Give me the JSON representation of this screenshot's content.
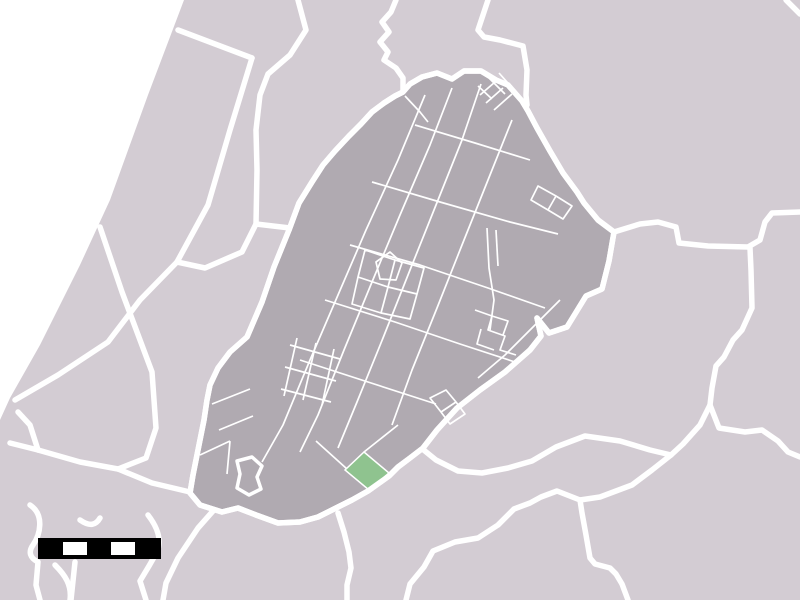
{
  "map": {
    "width": 800,
    "height": 600,
    "colors": {
      "sea": "#ffffff",
      "land": "#d3ccd3",
      "municipality": "#b0aab1",
      "selected_locality": "#8fc38f",
      "border": "#ffffff",
      "scalebar_bar": "#000000",
      "scalebar_block": "#ffffff"
    },
    "sea_path": "M 0,0 L 184,0 L 148,95 L 110,200 L 80,265 L 40,345 L 10,398 L 0,420 Z",
    "municipality_outline": "M 403,92 L 410,84 L 422,77 L 437,73 L 452,79 L 464,71 L 481,71 L 496,80 L 508,85 L 515,93 L 522,101 L 528,111 L 537,128 L 550,151 L 563,173 L 577,192 L 584,203 L 598,220 L 614,232 L 609,261 L 602,289 L 586,296 L 567,327 L 549,333 L 537,318 L 541,336 L 530,350 L 505,372 L 480,390 L 457,408 L 437,430 L 423,448 L 410,458 L 398,467 L 389,476 L 368,491 L 352,500 L 336,508 L 318,517 L 300,522 L 278,523 L 256,515 L 238,508 L 222,512 L 200,505 L 190,493 L 193,475 L 198,450 L 204,420 L 207,400 L 210,385 L 218,368 L 230,352 L 247,337 L 262,302 L 274,267 L 289,230 L 299,203 L 312,182 L 323,165 L 335,151 L 349,136 L 361,124 L 372,112 L 384,103 L 395,96 Z",
    "selected_locality_path": "M 364,452 L 389,473 L 369,490 L 345,470 Z",
    "lake_outline_path": "M 237,461 L 252,457 L 262,466 L 257,477 L 261,489 L 249,495 L 237,488 L 240,474 Z",
    "neighbor_borders": [
      "M 178,30 L 252,58",
      "M 252,58 L 230,130 L 208,205 L 177,262",
      "M 177,262 L 205,268 L 242,252 L 256,224 L 290,228",
      "M 298,0 L 306,30 L 290,55 L 268,74 L 260,95 L 256,130 L 257,170 L 256,224",
      "M 177,262 L 140,300 L 108,342 L 58,375 L 15,400",
      "M 100,227 L 122,292 L 152,372 L 156,428 L 146,458 L 118,469 L 80,462 L 38,450 L 10,443",
      "M 118,469 L 152,483 L 190,492",
      "M 38,450 L 30,425 L 18,412",
      "M 30,505 C 45,515 40,535 33,545 C 28,552 30,558 38,562 L 36,585 L 40,600",
      "M 80,520 C 90,527 96,525 100,518",
      "M 148,515 C 158,528 162,540 157,552 L 149,566 L 140,581 L 146,600",
      "M 55,565 C 65,575 72,585 70,600",
      "M 75,562 L 71,600",
      "M 213,511 L 198,528 L 178,558 L 166,583 L 163,600",
      "M 338,513 L 344,532 L 349,552 L 351,568 L 347,585 L 347,600",
      "M 420,447 L 436,460 L 458,471 L 482,473 L 508,468 L 532,461 L 556,447 L 585,436 L 620,441 L 650,450 L 671,455",
      "M 671,455 L 683,444 L 700,425 L 710,405 L 712,388 L 716,366 L 724,357 L 733,340 L 742,330 L 752,308 L 751,270 L 750,248",
      "M 710,405 L 719,428 L 745,432 L 762,430 L 778,441 L 788,452 L 800,457",
      "M 671,455 L 652,470 L 632,485 L 600,497 L 580,500 L 557,491 L 541,497 L 530,503 L 514,509 L 498,525 L 478,538 L 455,542 L 433,551 L 424,567 L 410,584 L 406,600",
      "M 580,500 L 582,513 L 586,535 L 590,558 L 595,564 L 610,568 L 616,574 L 622,584 L 628,600",
      "M 614,232 L 640,224 L 658,222 L 676,227 L 679,243 L 708,246 L 748,247 L 760,240 L 765,222 L 772,213 L 800,212",
      "M 786,0 L 800,14",
      "M 396,0 L 391,12 L 382,22 L 389,32 L 380,42 L 388,52 L 384,60 L 396,68 L 403,78 L 403,92",
      "M 488,0 L 478,30 L 484,37 L 500,40 L 523,46 L 527,70 L 526,95 L 527,105"
    ],
    "inner_parcel_lines": [
      "M 425,95 L 398,160 L 366,230 L 338,295 L 310,360 L 283,425 L 262,462",
      "M 452,88 L 430,145 L 400,215 L 372,282 L 344,350 L 318,415 L 300,452",
      "M 481,84 L 462,140 L 436,205 L 410,270 L 383,338 L 357,402 L 338,448",
      "M 512,120 L 488,180 L 462,245 L 437,308 L 412,370 L 392,425",
      "M 415,125 L 475,143 L 530,160",
      "M 372,182 L 440,202 L 510,222 L 558,234",
      "M 350,245 L 420,265 L 488,288 L 545,308",
      "M 325,300 L 395,322 L 460,344 L 515,362",
      "M 300,360 L 368,382 L 436,404",
      "M 487,228 L 489,268 L 494,300 L 490,330",
      "M 496,230 L 498,266",
      "M 560,300 L 530,330 L 505,355 L 478,378",
      "M 480,95 L 495,82 M 486,103 L 503,88 M 494,110 L 512,94 M 478,86 L 492,99 M 488,77 L 505,94 M 499,73 L 514,90",
      "M 365,250 L 395,260 L 388,287 L 358,277 Z M 395,260 L 424,268 L 417,294 L 388,287 Z M 358,277 L 388,287 L 381,313 L 352,304 Z M 388,287 L 417,294 L 410,319 L 381,313 Z M 376,262 L 390,252 L 402,263 L 396,280 L 380,279 Z",
      "M 290,345 L 340,359 M 285,367 L 336,381 M 281,389 L 331,402 M 297,338 L 284,396 M 316,343 L 303,400 M 334,349 L 322,405",
      "M 475,310 L 492,316 L 488,330 L 505,336 L 500,350 L 516,355 M 492,316 L 508,321 L 503,335 M 481,329 L 477,344 L 494,350",
      "M 538,186 L 556,196 L 548,210 L 531,200 Z M 556,196 L 572,206 L 563,219 L 548,210 Z",
      "M 430,398 L 446,390 L 456,402 L 441,412 Z M 441,412 L 456,402 L 465,414 L 450,424 Z",
      "M 212,404 L 250,389 M 219,430 L 253,416 M 200,455 L 230,441 M 230,441 L 227,474",
      "M 364,452 L 398,425 M 347,469 L 316,441",
      "M 405,96 L 420,112 L 428,122"
    ],
    "scalebar": {
      "bar": {
        "x": 38,
        "y": 538,
        "w": 123,
        "h": 21
      },
      "blocks": [
        {
          "x": 63,
          "y": 542,
          "w": 24,
          "h": 13
        },
        {
          "x": 111,
          "y": 542,
          "w": 24,
          "h": 13
        }
      ]
    },
    "stroke_widths": {
      "municipal_border": 5.5,
      "parcel_line": 1.7,
      "lake": 3.5
    }
  }
}
